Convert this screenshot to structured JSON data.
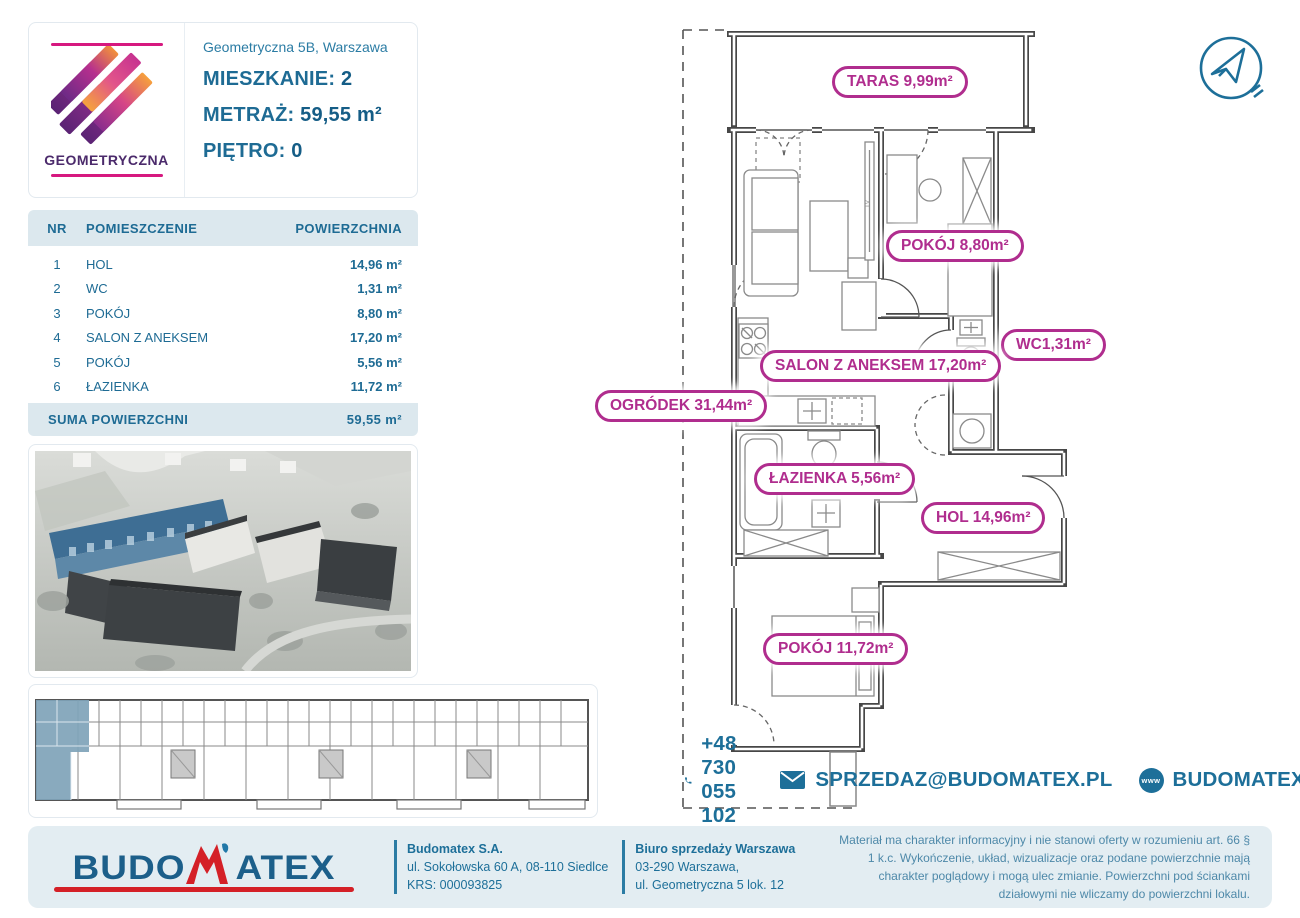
{
  "project": {
    "brand": "GEOMETRYCZNA",
    "address": "Geometryczna 5B, Warszawa"
  },
  "unit": {
    "apartment_label": "MIESZKANIE:",
    "apartment_value": "2",
    "area_label": "METRAŻ:",
    "area_value": "59,55 m²",
    "floor_label": "PIĘTRO:",
    "floor_value": "0"
  },
  "table": {
    "headers": {
      "nr": "NR",
      "room": "POMIESZCZENIE",
      "area": "POWIERZCHNIA"
    },
    "rows": [
      {
        "nr": "1",
        "room": "HOL",
        "area": "14,96 m²"
      },
      {
        "nr": "2",
        "room": "WC",
        "area": "1,31 m²"
      },
      {
        "nr": "3",
        "room": "POKÓJ",
        "area": "8,80 m²"
      },
      {
        "nr": "4",
        "room": "SALON Z ANEKSEM",
        "area": "17,20 m²"
      },
      {
        "nr": "5",
        "room": "POKÓJ",
        "area": "5,56 m²"
      },
      {
        "nr": "6",
        "room": "ŁAZIENKA",
        "area": "11,72 m²"
      }
    ],
    "suma_label": "SUMA POWIERZCHNI",
    "suma_value": "59,55 m²"
  },
  "plan": {
    "labels": {
      "taras": "TARAS 9,99m²",
      "pokoj1": "POKÓJ 8,80m²",
      "wc": "WC1,31m²",
      "salon": "SALON Z ANEKSEM 17,20m²",
      "ogrodek": "OGRÓDEK 31,44m²",
      "lazienka": "ŁAZIENKA 5,56m²",
      "hol": "HOL 14,96m²",
      "pokoj2": "POKÓJ 11,72m²"
    },
    "tv_label": "TV"
  },
  "contact": {
    "phone": "+48 730 055 102",
    "email": "SPRZEDAZ@BUDOMATEX.PL",
    "website": "BUDOMATEX.PL",
    "www_icon_text": "www"
  },
  "footer": {
    "logo_part1": "BUDO",
    "logo_part2": "ATEX",
    "company": {
      "name": "Budomatex S.A.",
      "address": "ul. Sokołowska 60 A, 08-110 Siedlce",
      "krs": "KRS: 000093825"
    },
    "office": {
      "name": "Biuro sprzedaży Warszawa",
      "line2": "03-290 Warszawa,",
      "line3": "ul. Geometryczna 5 lok. 12"
    },
    "legal": "Materiał ma charakter informacyjny i nie stanowi oferty w rozumieniu art. 66 § 1 k.c. Wykończenie, układ, wizualizacje oraz podane powierzchnie mają charakter poglądowy i mogą ulec zmianie. Powierzchni pod ściankami działowymi nie wliczamy do powierzchni lokalu."
  },
  "colors": {
    "teal": "#1d6f99",
    "magenta": "#b02d8e",
    "band": "#dce8ee",
    "highlight_blue": "#7fa3b8"
  }
}
